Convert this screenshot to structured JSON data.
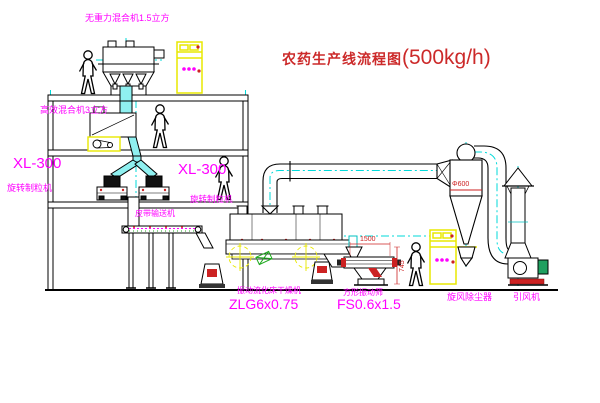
{
  "title": {
    "name": "农药生产线流程图",
    "capacity": "(500kg/h)"
  },
  "equipment": {
    "top_mixer_label": "无重力混合机1.5立方",
    "mid_mixer_label": "高效混合机3立方",
    "granulator_left": {
      "model": "XL-300",
      "name": "旋转制粒机"
    },
    "granulator_mid": {
      "model": "XL-300",
      "name": "旋转制粒机"
    },
    "belt_conveyor_label": "皮带输送机",
    "dryer": {
      "name": "振动流化床干燥机",
      "model": "ZLG6x0.75"
    },
    "sieve": {
      "name": "方形振动筛",
      "model": "FS0.6x1.5"
    },
    "cyclone_label": "旋风除尘器",
    "fan_label": "引风机"
  },
  "dimensions": {
    "sieve_length": "1500",
    "sieve_height": "745",
    "cyclone_diameter": "Φ600"
  },
  "colors": {
    "label_magenta": "#ff00ff",
    "title_red": "#cc2a2a",
    "dimension_red": "#cc2222",
    "centerline_cyan": "#00dada",
    "chute_fill_cyan": "#8ff0f0",
    "cabinet_yellow": "#e8e800",
    "machine_green": "#1faa1f",
    "line_black": "#000000",
    "background": "#ffffff"
  }
}
